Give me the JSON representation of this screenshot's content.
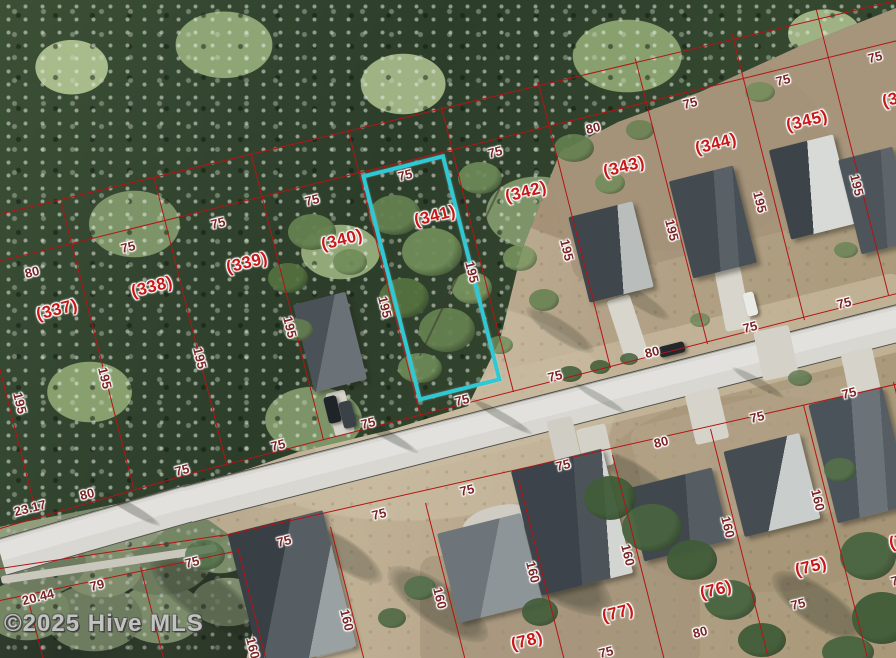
{
  "map": {
    "watermark": "©2025 Hive MLS",
    "highlighted_lot": "(341)",
    "colors": {
      "parcel_line": "#b31414",
      "lot_label": "#c91818",
      "dimension_label": "#7b2525",
      "highlight_outline": "#2fc8d4"
    },
    "lot_labels": [
      {
        "text": "(337)",
        "x": 57,
        "y": 310
      },
      {
        "text": "(338)",
        "x": 152,
        "y": 287
      },
      {
        "text": "(339)",
        "x": 247,
        "y": 263
      },
      {
        "text": "(340)",
        "x": 342,
        "y": 240
      },
      {
        "text": "(341)",
        "x": 435,
        "y": 216
      },
      {
        "text": "(342)",
        "x": 526,
        "y": 192
      },
      {
        "text": "(343)",
        "x": 624,
        "y": 167
      },
      {
        "text": "(344)",
        "x": 716,
        "y": 144
      },
      {
        "text": "(345)",
        "x": 807,
        "y": 121
      },
      {
        "text": "(346)",
        "x": 903,
        "y": 97
      },
      {
        "text": "(75)",
        "x": 811,
        "y": 567
      },
      {
        "text": "(76)",
        "x": 716,
        "y": 590
      },
      {
        "text": "(77)",
        "x": 618,
        "y": 613
      },
      {
        "text": "(78)",
        "x": 527,
        "y": 641
      },
      {
        "text": "(74)",
        "x": 905,
        "y": 540
      }
    ],
    "dimension_labels": [
      {
        "text": "80",
        "x": 32,
        "y": 272,
        "rot": -14
      },
      {
        "text": "75",
        "x": 128,
        "y": 247,
        "rot": -14
      },
      {
        "text": "75",
        "x": 218,
        "y": 223,
        "rot": -14
      },
      {
        "text": "75",
        "x": 312,
        "y": 200,
        "rot": -14
      },
      {
        "text": "75",
        "x": 405,
        "y": 175,
        "rot": -14
      },
      {
        "text": "75",
        "x": 495,
        "y": 152,
        "rot": -14
      },
      {
        "text": "80",
        "x": 593,
        "y": 128,
        "rot": -14
      },
      {
        "text": "75",
        "x": 690,
        "y": 103,
        "rot": -14
      },
      {
        "text": "75",
        "x": 783,
        "y": 80,
        "rot": -14
      },
      {
        "text": "75",
        "x": 875,
        "y": 57,
        "rot": -14
      },
      {
        "text": "23.17",
        "x": 30,
        "y": 508,
        "rot": -14
      },
      {
        "text": "80",
        "x": 87,
        "y": 494,
        "rot": -14
      },
      {
        "text": "75",
        "x": 182,
        "y": 470,
        "rot": -14
      },
      {
        "text": "75",
        "x": 278,
        "y": 445,
        "rot": -14
      },
      {
        "text": "75",
        "x": 368,
        "y": 423,
        "rot": -14
      },
      {
        "text": "75",
        "x": 462,
        "y": 400,
        "rot": -14
      },
      {
        "text": "75",
        "x": 555,
        "y": 376,
        "rot": -14
      },
      {
        "text": "80",
        "x": 652,
        "y": 352,
        "rot": -14
      },
      {
        "text": "75",
        "x": 750,
        "y": 327,
        "rot": -14
      },
      {
        "text": "75",
        "x": 844,
        "y": 303,
        "rot": -14
      },
      {
        "text": "75",
        "x": 192,
        "y": 562,
        "rot": -14
      },
      {
        "text": "75",
        "x": 284,
        "y": 541,
        "rot": -14
      },
      {
        "text": "75",
        "x": 379,
        "y": 514,
        "rot": -14
      },
      {
        "text": "75",
        "x": 467,
        "y": 490,
        "rot": -14
      },
      {
        "text": "75",
        "x": 563,
        "y": 465,
        "rot": -14
      },
      {
        "text": "80",
        "x": 661,
        "y": 442,
        "rot": -14
      },
      {
        "text": "75",
        "x": 757,
        "y": 417,
        "rot": -14
      },
      {
        "text": "75",
        "x": 849,
        "y": 393,
        "rot": -14
      },
      {
        "text": "79",
        "x": 97,
        "y": 585,
        "rot": -14
      },
      {
        "text": "20.44",
        "x": 38,
        "y": 597,
        "rot": -14
      },
      {
        "text": "75",
        "x": 606,
        "y": 652,
        "rot": -14
      },
      {
        "text": "80",
        "x": 700,
        "y": 632,
        "rot": -14
      },
      {
        "text": "75",
        "x": 798,
        "y": 604,
        "rot": -14
      },
      {
        "text": "75",
        "x": 898,
        "y": 580,
        "rot": -14
      },
      {
        "text": "195",
        "x": 20,
        "y": 403,
        "rot": 76
      },
      {
        "text": "195",
        "x": 105,
        "y": 378,
        "rot": 76
      },
      {
        "text": "195",
        "x": 200,
        "y": 358,
        "rot": 76
      },
      {
        "text": "195",
        "x": 290,
        "y": 327,
        "rot": 76
      },
      {
        "text": "195",
        "x": 385,
        "y": 307,
        "rot": 76
      },
      {
        "text": "195",
        "x": 472,
        "y": 272,
        "rot": 76
      },
      {
        "text": "195",
        "x": 567,
        "y": 250,
        "rot": 76
      },
      {
        "text": "195",
        "x": 672,
        "y": 230,
        "rot": 76
      },
      {
        "text": "195",
        "x": 760,
        "y": 202,
        "rot": 76
      },
      {
        "text": "195",
        "x": 857,
        "y": 185,
        "rot": 76
      },
      {
        "text": "160",
        "x": 253,
        "y": 648,
        "rot": 76
      },
      {
        "text": "160",
        "x": 347,
        "y": 620,
        "rot": 76
      },
      {
        "text": "160",
        "x": 440,
        "y": 598,
        "rot": 76
      },
      {
        "text": "160",
        "x": 533,
        "y": 572,
        "rot": 76
      },
      {
        "text": "160",
        "x": 628,
        "y": 555,
        "rot": 76
      },
      {
        "text": "160",
        "x": 728,
        "y": 527,
        "rot": 76
      },
      {
        "text": "160",
        "x": 818,
        "y": 500,
        "rot": 76
      }
    ]
  }
}
